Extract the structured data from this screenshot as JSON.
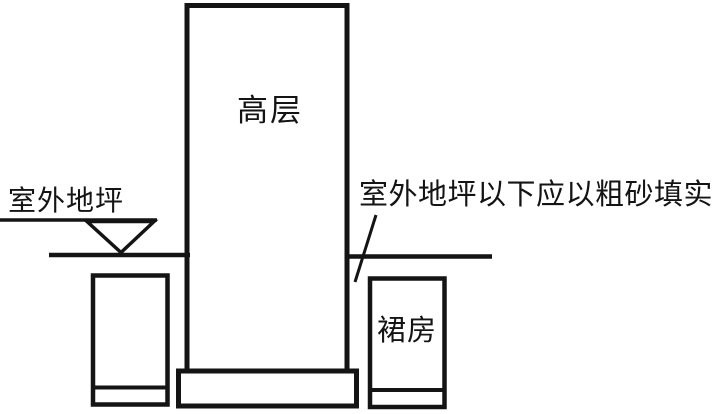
{
  "diagram": {
    "type": "building-section-sketch",
    "labels": {
      "tower": "高层",
      "podium": "裙房",
      "ground_level": "室外地坪",
      "fill_note": "室外地坪以下应以粗砂填实"
    },
    "colors": {
      "line": "#141414",
      "background": "#ffffff"
    }
  }
}
